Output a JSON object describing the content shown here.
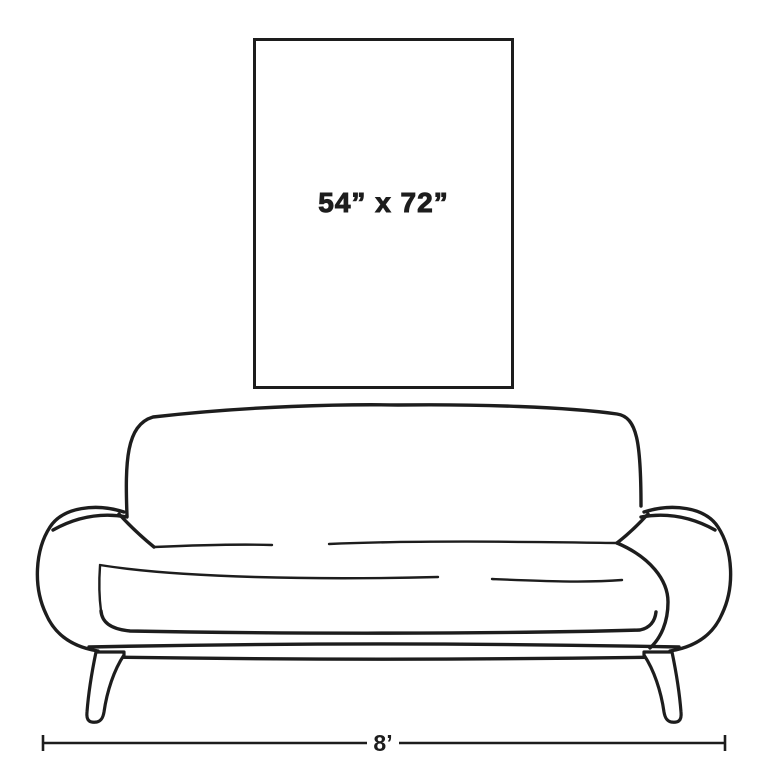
{
  "artwork": {
    "dimensions_label": "54” x 72”"
  },
  "sofa": {
    "width_label": "8’"
  },
  "colors": {
    "line": "#1d1d1d",
    "background": "#ffffff"
  }
}
